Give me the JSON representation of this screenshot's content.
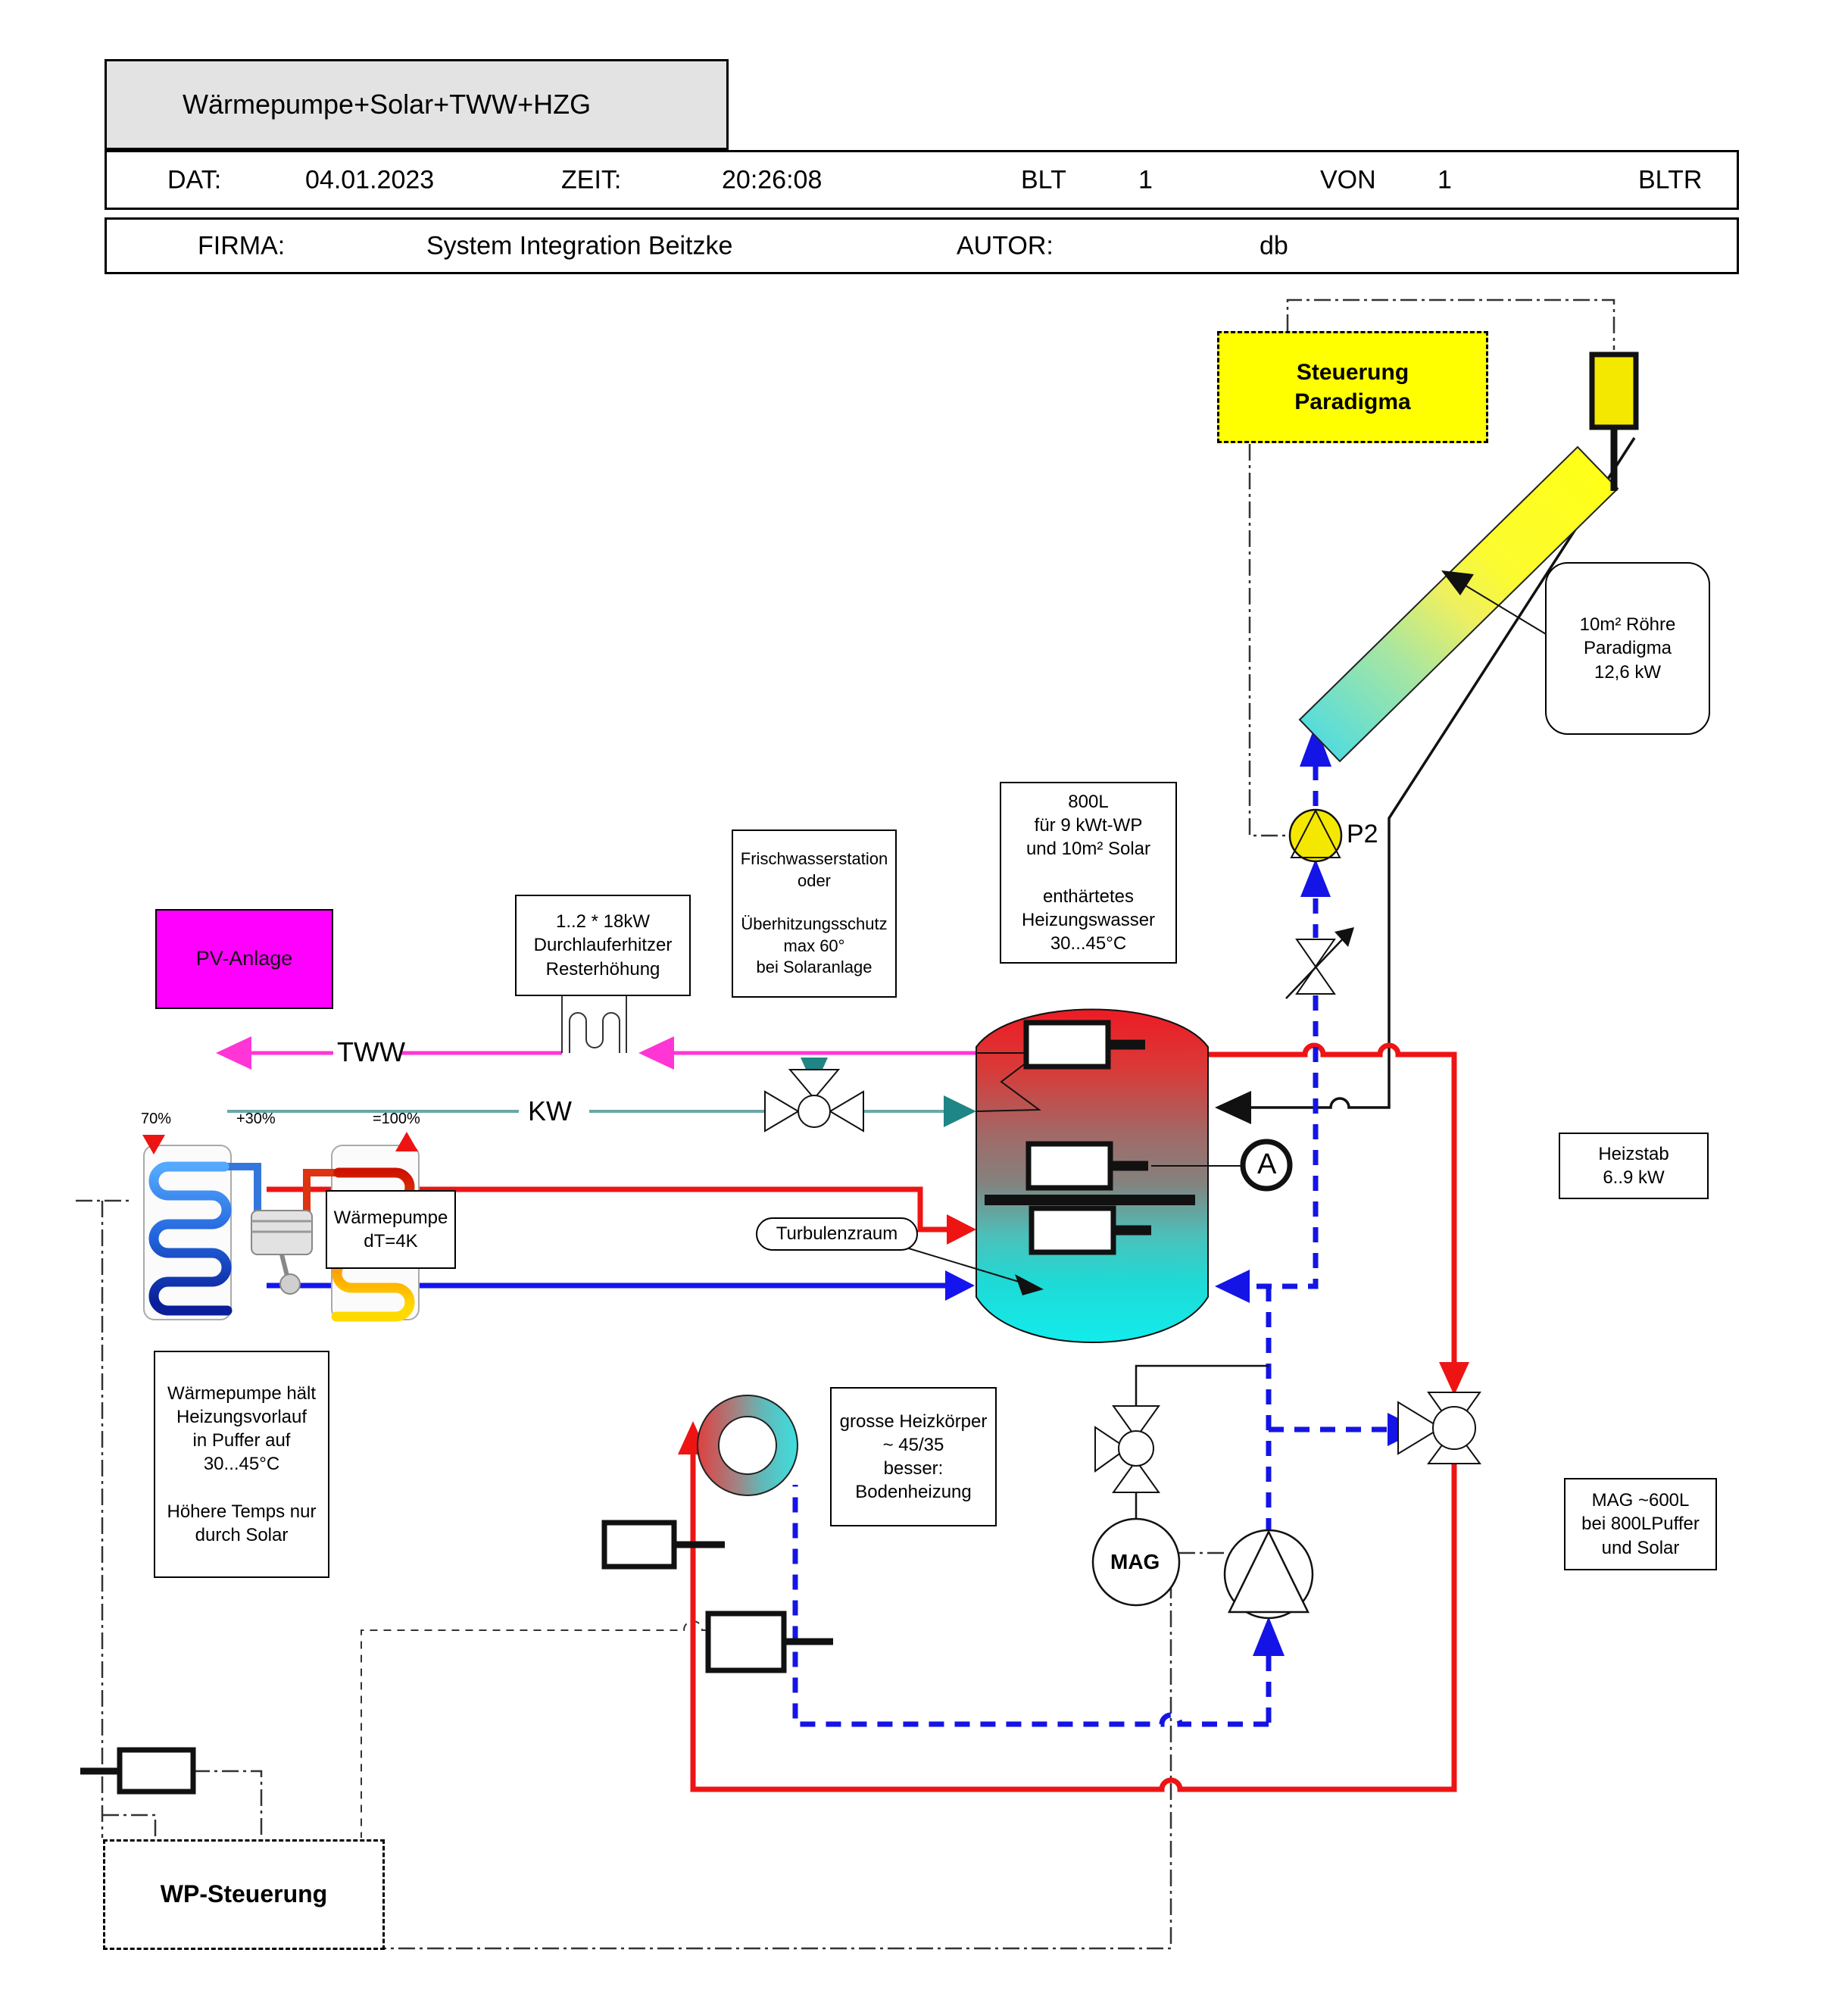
{
  "title_block": {
    "title": "Wärmepumpe+Solar+TWW+HZG",
    "dat_label": "DAT:",
    "dat_value": "04.01.2023",
    "zeit_label": "ZEIT:",
    "zeit_value": "20:26:08",
    "blt_label": "BLT",
    "blt_value": "1",
    "von_label": "VON",
    "von_value": "1",
    "bltr_label": "BLTR",
    "firma_label": "FIRMA:",
    "firma_value": "System Integration Beitzke",
    "autor_label": "AUTOR:",
    "autor_value": "db"
  },
  "labels": {
    "steuerung": "Steuerung\nParadigma",
    "collector_note": "10m² Röhre\nParadigma\n12,6 kW",
    "pump_p2": "P2",
    "tank_note": "800L\nfür 9 kWt-WP\nund 10m² Solar\n\nenthärtetes\nHeizungswasser\n30...45°C",
    "frischwasser_note": "Frischwasserstation\noder\n\nÜberhitzungsschutz\nmax 60°\nbei Solaranlage",
    "durchlauferhitzer_note": "1..2 * 18kW\nDurchlauferhitzer\nResterhöhung",
    "pv": "PV-Anlage",
    "tww": "TWW",
    "kw": "KW",
    "waermepumpe_note": "Wärmepumpe\ndT=4K",
    "turbulenzraum": "Turbulenzraum",
    "sensor_a": "A",
    "heizstab_note": "Heizstab\n6..9 kW",
    "wp_haelt_note": "Wärmepumpe hält\nHeizungsvorlauf\nin Puffer auf\n30...45°C\n\nHöhere Temps nur\ndurch Solar",
    "heizkoerper_note": "grosse Heizkörper\n~ 45/35\nbesser:\nBodenheizung",
    "mag": "MAG",
    "mag_note": "MAG ~600L\nbei 800LPuffer\nund Solar",
    "wp_steuerung": "WP-Steuerung",
    "hp_left_pct": "70%",
    "hp_mid_pct": "+30%",
    "hp_right_pct": "=100%"
  },
  "colors": {
    "hot_pipe": "#ee1414",
    "cold_pipe": "#1414ee",
    "solar_dashed": "#1414e6",
    "tww_line": "#ff35d6",
    "kw_line": "#6aa8a8",
    "kw_arrow": "#1f8585",
    "pv_fill": "#ff00ff",
    "control_yellow": "#ffff00",
    "pump_yellow": "#f5e800",
    "title_bg": "#e3e3e3",
    "tank_top": "#ed1b24",
    "tank_bottom": "#12ecec"
  }
}
